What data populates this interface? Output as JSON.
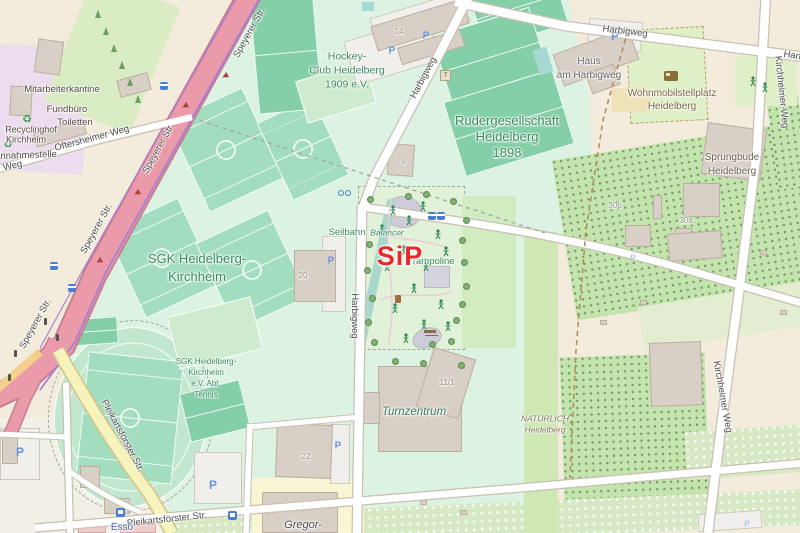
{
  "annotation": {
    "sip_label": "SiP"
  },
  "streets": {
    "speyerer": "Speyerer Str.",
    "harbigweg": "Harbigweg",
    "kirchheimer_weg": "Kirchheimer Weg",
    "oftersheimer_weg": "Oftersheimer Weg",
    "pleikartsfoerster": "Pleikartsförster Str.",
    "weg_fragment": "r Weg"
  },
  "labels": {
    "hockey": {
      "l1": "Hockey-",
      "l2": "Club Heidelberg",
      "l3": "1909 e.V."
    },
    "ruder": {
      "l1": "Rudergesellschaft",
      "l2": "Heidelberg",
      "l3": "1898"
    },
    "sgk": {
      "l1": "SGK Heidelberg-",
      "l2": "Kirchheim"
    },
    "tennis": {
      "l1": "SGK Heidelberg-",
      "l2": "Kirchheim",
      "l3": "e.V. Abt.",
      "l4": "Tennis"
    },
    "turnzentrum": "Turnzentrum",
    "sprungbude": {
      "l1": "Sprungbude",
      "l2": "Heidelberg"
    },
    "haus": {
      "l1": "Haus",
      "l2": "am Harbigweg"
    },
    "wohnmobil": {
      "l1": "Wohnmobilstellplatz",
      "l2": "Heidelberg"
    },
    "natuerlich": {
      "l1": "NATÜRLICH",
      "l2": "Heidelberg"
    },
    "gregor": "Gregor-",
    "esso": "Esso",
    "mitarbeiterkantine": "Mitarbeiterkantine",
    "fundbuero": "Fundbüro",
    "toiletten": "Toiletten",
    "recyclinghof": {
      "l1": "Recyclinghof",
      "l2": "Kirchheim"
    },
    "annahmestelle": "annahmestelle",
    "seilbahn": "Seilbahn",
    "balancer": "Balancer",
    "trampoline": "Trampoline"
  },
  "housenumbers": {
    "n14": "14",
    "n7": "7",
    "n9": "9",
    "n20": "20",
    "n22": "22",
    "n30a": "30a",
    "n30b": "30b",
    "n11_1": "11/1"
  },
  "icons": {
    "parking_label": "P",
    "recycling_glyph": "♻",
    "semantic_names": [
      "parking-icon",
      "recycling-icon",
      "tree-icon",
      "playground-figure-icon",
      "oneway-arrow-icon",
      "bus-stop-icon",
      "fuel-station-icon",
      "caravan-icon",
      "picnic-table-icon",
      "waste-basket-icon",
      "bicycle-parking-icon",
      "traffic-signal-icon",
      "pool-icon"
    ]
  },
  "colors": {
    "bg": "#f3ecdc",
    "mint": "#dcf2e2",
    "grass": "#d9ecc3",
    "purple": "#ebdcee",
    "pitchGreen": "#a3ddbf",
    "pitchTeal": "#85cfa8",
    "courtLight": "#cdeccf",
    "trackBase": "#c2e7cf",
    "playground": "#e2f2d8",
    "allotA": "#c4e4ae",
    "allotB": "#d6e9c4",
    "paleBand": "#e2eecf",
    "natStrip": "#cfe8b4",
    "building": "#d8cfc7",
    "buildingBorder": "#bcaf9e",
    "roadWhite": "#ffffff",
    "casing": "#c9c0b2",
    "roadPink": "#ea9aa8",
    "pinkCasing": "#c77e92",
    "cycle": "#a87fd0",
    "roadYellow": "#f7f3bd",
    "yellowCasing": "#d2c88e",
    "parkingLot": "#f0efeb",
    "labelGreen": "#3c8a60",
    "streetGray": "#4d4d4d",
    "numGray": "#97897e",
    "sipRed": "#e8282b",
    "parkBlue": "#6b93e0",
    "busBlue": "#4a7fd4",
    "brown": "#7d6747",
    "dashBrown": "#b68d59"
  }
}
